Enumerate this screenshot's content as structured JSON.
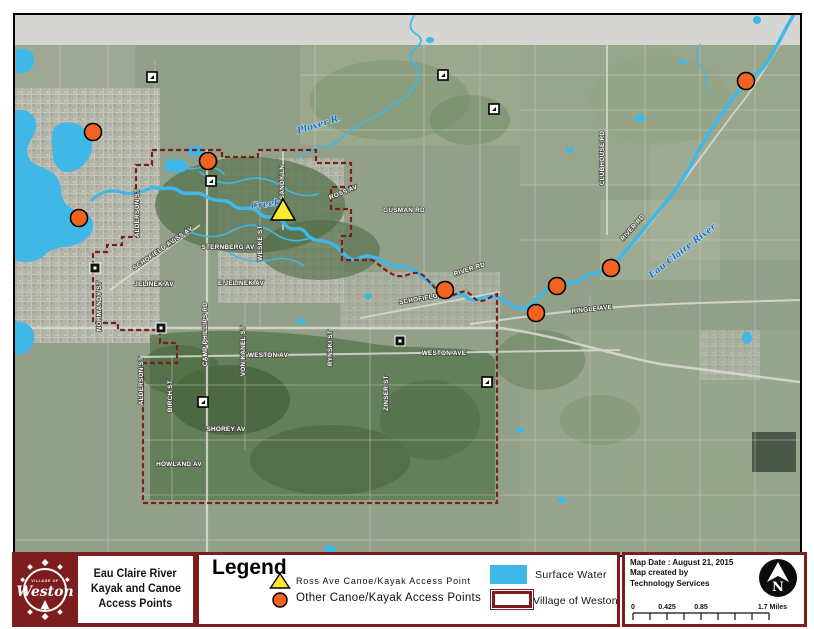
{
  "title_block": {
    "logo": {
      "top_text": "VILLAGE OF",
      "name": "Weston"
    },
    "lines": [
      "Eau Claire River",
      "Kayak and Canoe",
      "Access Points"
    ]
  },
  "legend": {
    "heading": "Legend",
    "items": [
      {
        "symbol": "yellow-triangle",
        "label": "Ross Ave Canoe/Kayak Access Point"
      },
      {
        "symbol": "orange-circle",
        "label": "Other Canoe/Kayak Access Points"
      },
      {
        "symbol": "water-swatch",
        "label": "Surface Water"
      },
      {
        "symbol": "boundary-swatch",
        "label": "Village of Weston"
      }
    ]
  },
  "info_box": {
    "map_date": "Map Date : August 21, 2015",
    "created_line1": "Map created by",
    "created_line2": "Technology Services",
    "north_label": "N",
    "scale_labels": [
      "0",
      "0.425",
      "0.85",
      "1.7 Miles"
    ]
  },
  "map": {
    "colors": {
      "water": "#3FB8E8",
      "boundary": "#7A201A",
      "orange_marker": "#F26221",
      "yellow_marker": "#FFE92B",
      "maroon": "#7D1D1D",
      "base": "#93A089"
    },
    "road_labels": [
      {
        "text": "CLUBHOUSE RD",
        "x": 604,
        "y": 158,
        "rot": -90
      },
      {
        "text": "RIVER RD",
        "x": 634,
        "y": 229,
        "rot": -48
      },
      {
        "text": "RIVER RD",
        "x": 470,
        "y": 271,
        "rot": -18
      },
      {
        "text": "RINGLE AVE",
        "x": 592,
        "y": 311,
        "rot": -6
      },
      {
        "text": "GUSMAN RD",
        "x": 404,
        "y": 212,
        "rot": 0
      },
      {
        "text": "ROSS AV",
        "x": 344,
        "y": 194,
        "rot": -22
      },
      {
        "text": "ROSS AV",
        "x": 181,
        "y": 238,
        "rot": -35
      },
      {
        "text": "SANDY LN",
        "x": 284,
        "y": 182,
        "rot": -90
      },
      {
        "text": "STERNBERG AV",
        "x": 228,
        "y": 249,
        "rot": 0
      },
      {
        "text": "WESKE ST",
        "x": 262,
        "y": 243,
        "rot": -90
      },
      {
        "text": "JELINEK AV",
        "x": 154,
        "y": 286,
        "rot": 0
      },
      {
        "text": "E JELINEK AV",
        "x": 241,
        "y": 285,
        "rot": 0
      },
      {
        "text": "NORMANDY ST",
        "x": 101,
        "y": 306,
        "rot": -90
      },
      {
        "text": "CAMP PHILLIPS RD",
        "x": 207,
        "y": 334,
        "rot": -90
      },
      {
        "text": "VON KANEL ST",
        "x": 245,
        "y": 351,
        "rot": -90
      },
      {
        "text": "WESTON AV",
        "x": 268,
        "y": 357,
        "rot": 0
      },
      {
        "text": "WESTON AVE",
        "x": 444,
        "y": 355,
        "rot": 0
      },
      {
        "text": "ALDERSON ST",
        "x": 139,
        "y": 213,
        "rot": -90
      },
      {
        "text": "ALDERSON ST",
        "x": 143,
        "y": 381,
        "rot": -90
      },
      {
        "text": "BIRCH ST",
        "x": 172,
        "y": 396,
        "rot": -90
      },
      {
        "text": "SHOREY AV",
        "x": 226,
        "y": 431,
        "rot": 0
      },
      {
        "text": "HOWLAND AV",
        "x": 179,
        "y": 466,
        "rot": 0
      },
      {
        "text": "ZINSER ST",
        "x": 388,
        "y": 393,
        "rot": -90
      },
      {
        "text": "SCHOFIELD AV",
        "x": 155,
        "y": 256,
        "rot": -35
      },
      {
        "text": "SCHOFIELD AV",
        "x": 424,
        "y": 300,
        "rot": -10
      },
      {
        "text": "RYNSKI ST",
        "x": 332,
        "y": 348,
        "rot": -90
      }
    ],
    "water_labels": [
      {
        "text": "Eau Claire River",
        "x": 684,
        "y": 253,
        "rot": -38,
        "size": 9
      },
      {
        "text": "Plover R.",
        "x": 320,
        "y": 127,
        "rot": -18,
        "size": 7
      },
      {
        "text": "Creek",
        "x": 266,
        "y": 207,
        "rot": -8,
        "size": 6.5
      }
    ],
    "access_points": {
      "ross_ave": {
        "x": 283,
        "y": 212
      },
      "others": [
        [
          93,
          132
        ],
        [
          79,
          218
        ],
        [
          208,
          161
        ],
        [
          445,
          290
        ],
        [
          536,
          313
        ],
        [
          557,
          286
        ],
        [
          611,
          268
        ],
        [
          746,
          81
        ]
      ]
    },
    "highway_markers": {
      "white": [
        [
          152,
          77
        ],
        [
          443,
          75
        ],
        [
          494,
          109
        ],
        [
          211,
          181
        ],
        [
          203,
          402
        ],
        [
          487,
          382
        ]
      ],
      "black": [
        [
          95,
          268
        ],
        [
          161,
          328
        ],
        [
          400,
          341
        ]
      ]
    }
  }
}
